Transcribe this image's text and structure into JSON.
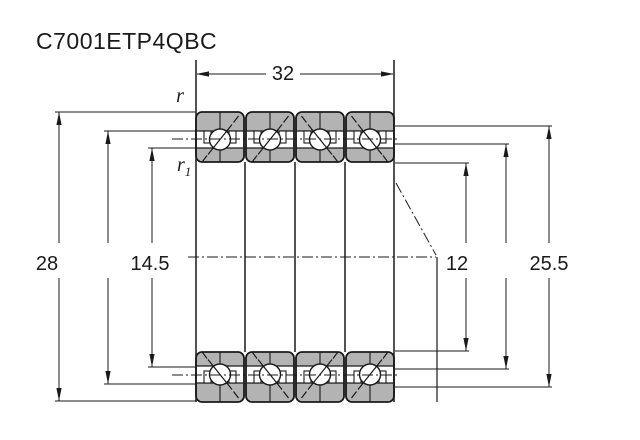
{
  "title": "C7001ETP4QBC",
  "drawing": {
    "type": "bearing-cross-section",
    "bearing_count": 4,
    "arrangement": "quad-set",
    "dimensions": {
      "width_top": "32",
      "outer_left": "28",
      "inner_left": "14.5",
      "bore_right": "12",
      "outer_right": "25.5"
    },
    "labels": {
      "chamfer_outer": "r",
      "chamfer_inner_r": "r",
      "chamfer_inner_sub": "1"
    },
    "colors": {
      "ring_fill": "#b3b3b3",
      "line": "#1a1a1a",
      "background": "#ffffff"
    }
  }
}
